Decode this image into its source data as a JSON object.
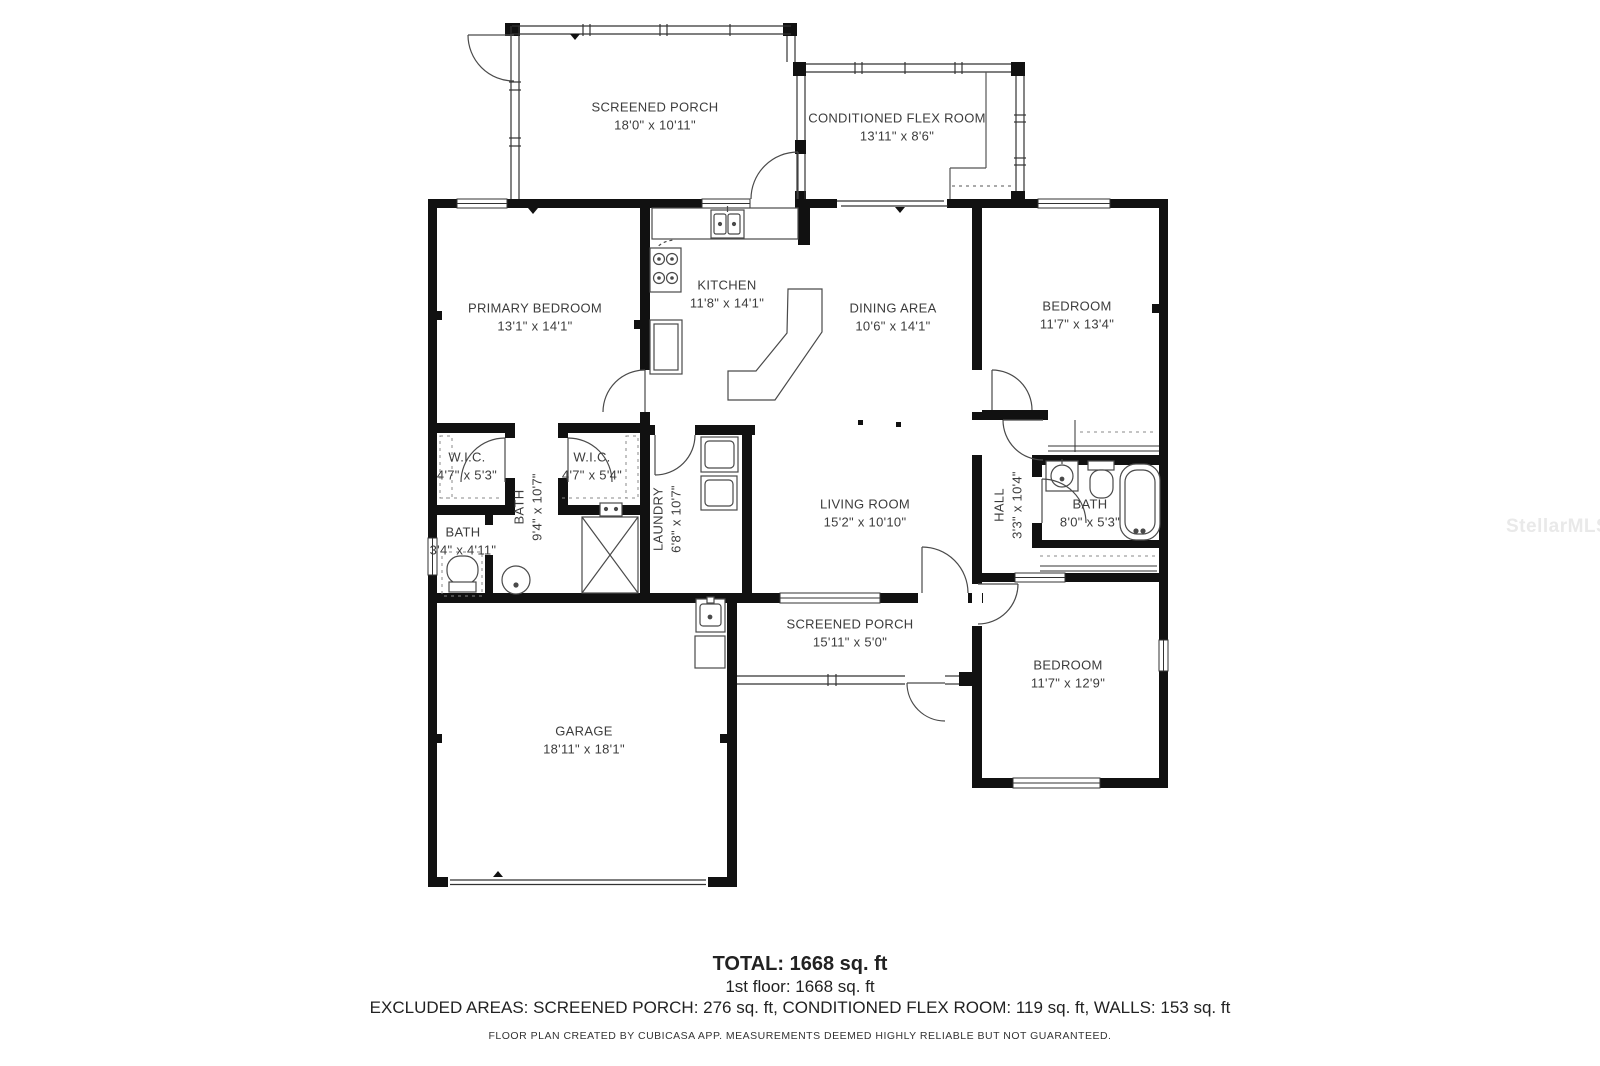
{
  "watermark": "StellarMLS",
  "footer": {
    "total": "TOTAL: 1668 sq. ft",
    "first_floor": "1st floor: 1668 sq. ft",
    "excluded": "EXCLUDED AREAS: SCREENED PORCH: 276 sq. ft, CONDITIONED FLEX ROOM: 119 sq. ft, WALLS: 153 sq. ft",
    "disclaimer": "FLOOR PLAN CREATED BY CUBICASA APP. MEASUREMENTS DEEMED HIGHLY RELIABLE BUT NOT GUARANTEED."
  },
  "rooms": {
    "screened_porch_top": {
      "name": "SCREENED PORCH",
      "dims": "18'0\" x 10'11\""
    },
    "conditioned_flex_room": {
      "name": "CONDITIONED FLEX ROOM",
      "dims": "13'11\" x 8'6\""
    },
    "primary_bedroom": {
      "name": "PRIMARY BEDROOM",
      "dims": "13'1\" x 14'1\""
    },
    "kitchen": {
      "name": "KITCHEN",
      "dims": "11'8\" x 14'1\""
    },
    "dining_area": {
      "name": "DINING AREA",
      "dims": "10'6\" x 14'1\""
    },
    "bedroom_top_right": {
      "name": "BEDROOM",
      "dims": "11'7\" x 13'4\""
    },
    "wic_left": {
      "name": "W.I.C.",
      "dims": "4'7\" x 5'3\""
    },
    "wic_right": {
      "name": "W.I.C.",
      "dims": "4'7\" x 5'4\""
    },
    "bath_primary": {
      "name": "BATH",
      "dims": "9'4\" x 10'7\""
    },
    "bath_small": {
      "name": "BATH",
      "dims": "3'4\" x 4'11\""
    },
    "laundry": {
      "name": "LAUNDRY",
      "dims": "6'8\" x 10'7\""
    },
    "living_room": {
      "name": "LIVING ROOM",
      "dims": "15'2\" x 10'10\""
    },
    "hall": {
      "name": "HALL",
      "dims": "3'3\" x 10'4\""
    },
    "bath_hall": {
      "name": "BATH",
      "dims": "8'0\" x 5'3\""
    },
    "screened_porch_bottom": {
      "name": "SCREENED PORCH",
      "dims": "15'11\" x 5'0\""
    },
    "garage": {
      "name": "GARAGE",
      "dims": "18'11\" x 18'1\""
    },
    "bedroom_bottom_right": {
      "name": "BEDROOM",
      "dims": "11'7\" x 12'9\""
    }
  },
  "colors": {
    "wall": "#111111",
    "thin_line": "#4a4a4a",
    "label_text": "#3c3c3c",
    "footer_text": "#222222",
    "watermark": "#e9e9e9",
    "background": "#ffffff"
  }
}
